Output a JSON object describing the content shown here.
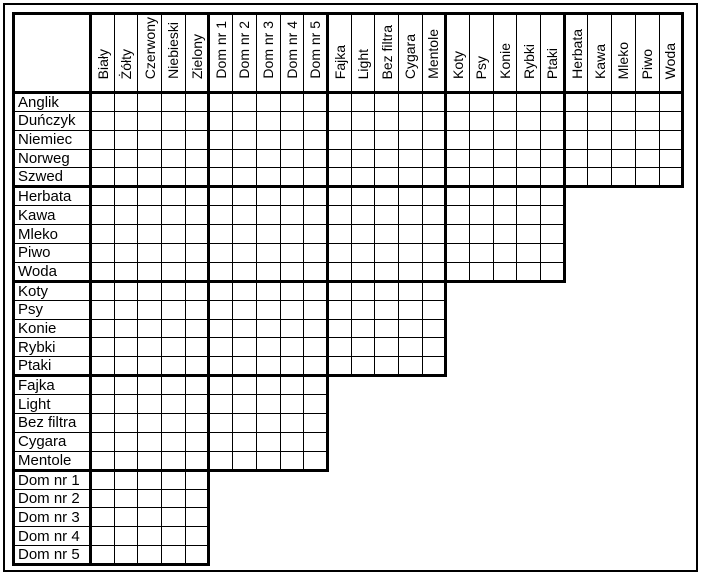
{
  "page": {
    "background_color": "#ffffff",
    "border_color": "#000000",
    "text_color": "#000000"
  },
  "puzzle": {
    "type": "logic-grid",
    "corner_cell": "",
    "column_groups": [
      {
        "name": "house-colors",
        "labels": [
          "Biały",
          "Żółty",
          "Czerwony",
          "Niebieski",
          "Zielony"
        ]
      },
      {
        "name": "house-numbers",
        "labels": [
          "Dom nr 1",
          "Dom nr 2",
          "Dom nr 3",
          "Dom nr 4",
          "Dom nr 5"
        ]
      },
      {
        "name": "cigarettes",
        "labels": [
          "Fajka",
          "Light",
          "Bez filtra",
          "Cygara",
          "Mentole"
        ]
      },
      {
        "name": "pets",
        "labels": [
          "Koty",
          "Psy",
          "Konie",
          "Rybki",
          "Ptaki"
        ]
      },
      {
        "name": "drinks",
        "labels": [
          "Herbata",
          "Kawa",
          "Mleko",
          "Piwo",
          "Woda"
        ]
      }
    ],
    "row_groups": [
      {
        "name": "nationalities",
        "labels": [
          "Anglik",
          "Duńczyk",
          "Niemiec",
          "Norweg",
          "Szwed"
        ],
        "col_group_span": 5
      },
      {
        "name": "drinks",
        "labels": [
          "Herbata",
          "Kawa",
          "Mleko",
          "Piwo",
          "Woda"
        ],
        "col_group_span": 4
      },
      {
        "name": "pets",
        "labels": [
          "Koty",
          "Psy",
          "Konie",
          "Rybki",
          "Ptaki"
        ],
        "col_group_span": 3
      },
      {
        "name": "cigarettes",
        "labels": [
          "Fajka",
          "Light",
          "Bez filtra",
          "Cygara",
          "Mentole"
        ],
        "col_group_span": 2
      },
      {
        "name": "house-numbers",
        "labels": [
          "Dom nr 1",
          "Dom nr 2",
          "Dom nr 3",
          "Dom nr 4",
          "Dom nr 5"
        ],
        "col_group_span": 1
      }
    ]
  }
}
